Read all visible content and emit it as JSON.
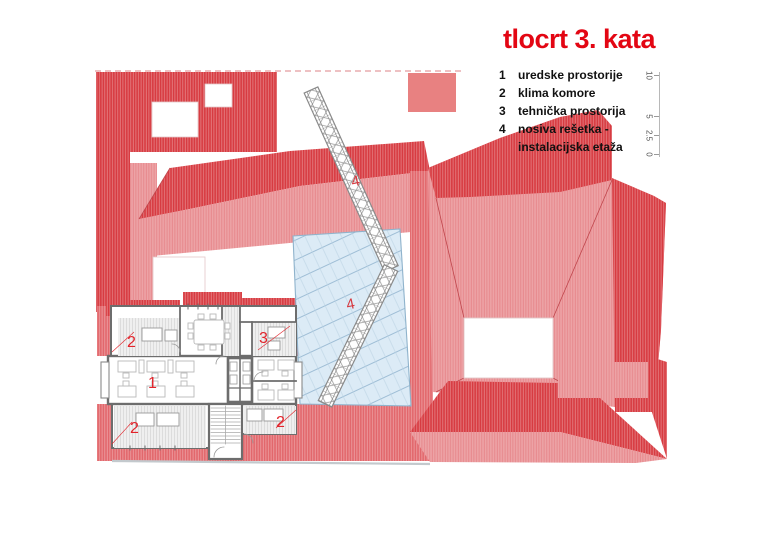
{
  "title": "tlocrt 3. kata",
  "legend": {
    "items": [
      {
        "num": "1",
        "label": "uredske prostorije"
      },
      {
        "num": "2",
        "label": "klima komore"
      },
      {
        "num": "3",
        "label": "tehnička prostorija"
      },
      {
        "num": "4",
        "label": "nosiva rešetka -",
        "label2": "instalacijska etaža"
      }
    ]
  },
  "scale": {
    "labels": [
      "10",
      "5",
      "2.5",
      "0"
    ]
  },
  "labels": {
    "office": "1",
    "klima_tl": "2",
    "tech": "3",
    "klima_bl": "2",
    "klima_br": "2",
    "truss_a": "4",
    "truss_b": "4"
  },
  "colors": {
    "title_red": "#e30613",
    "room_label_red": "#e2242b",
    "roof_dark": "#d73b41",
    "roof_medium": "#e2676c",
    "roof_light": "#eda3a6",
    "salmon_block": "#e88181",
    "glass_fill": "#dcebf6",
    "glass_line": "#a9c6dc",
    "wall_gray": "#6d6d6d",
    "furniture_gray": "#b9b9b9"
  }
}
